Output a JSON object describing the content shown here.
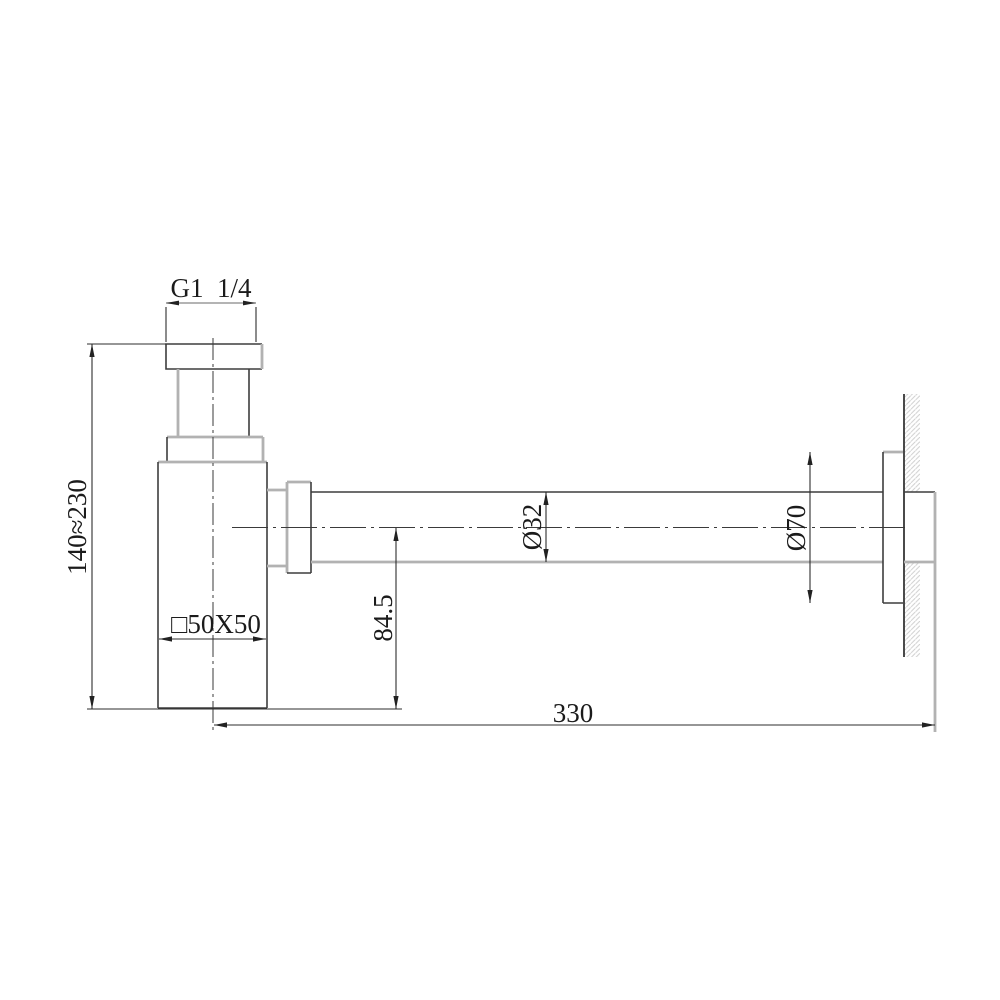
{
  "drawing": {
    "labels": {
      "thread": "G1  1/4",
      "height_range": "140≈230",
      "body_section": "□50X50",
      "outlet_drop": "84.5",
      "pipe_diameter": "Ø32",
      "flange_diameter": "Ø70",
      "projection_length": "330"
    },
    "colors": {
      "background": "#ffffff",
      "object_line": "#3d3d3d",
      "object_line_light": "#b2b2b2",
      "dimension_line": "#2e2e2e",
      "hatch_line": "#cfcfcf",
      "text": "#1b1b1b"
    }
  }
}
